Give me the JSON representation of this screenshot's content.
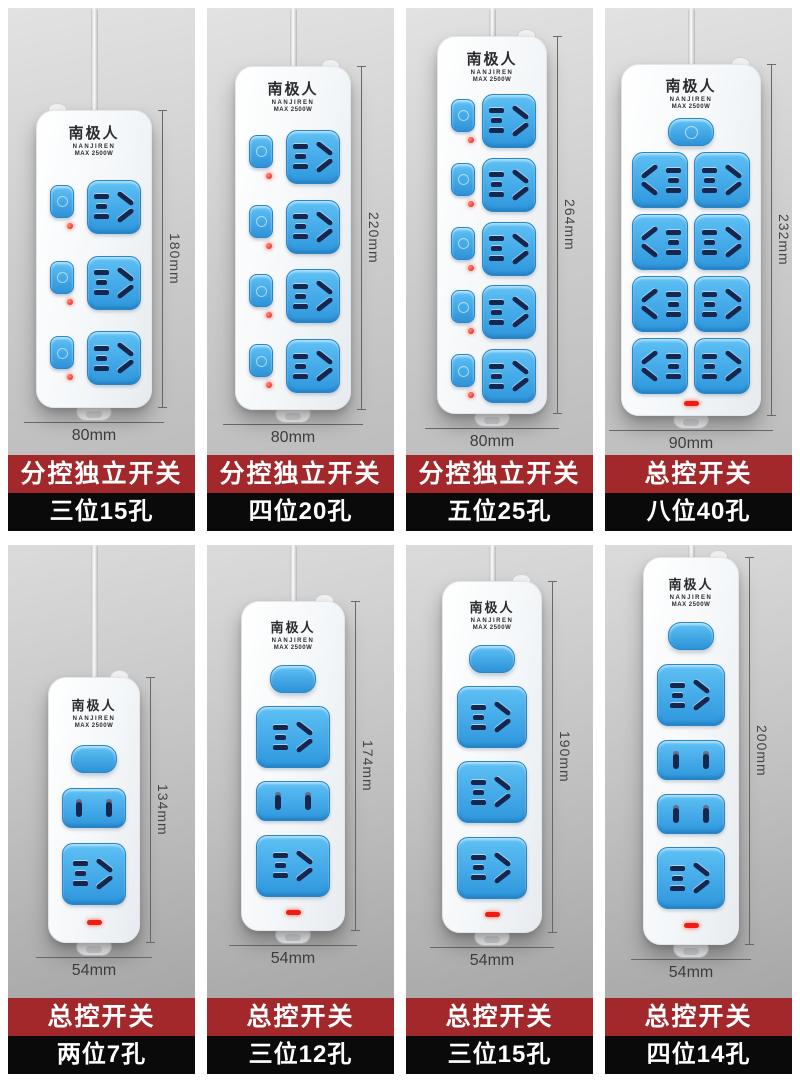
{
  "brand": {
    "name": "南极人",
    "latin": "NANJIREN",
    "power": "MAX 2500W"
  },
  "colors": {
    "banner_red": "#a2282b",
    "banner_black": "#0a0a0a",
    "socket_blue": "#3aa4e4",
    "strip_body": "#f5f7f9",
    "indicator_red": "#ef1c12",
    "background_gray": "#cccccc"
  },
  "products": [
    {
      "id": "p1",
      "switch_type": "individual",
      "banner": "分控独立开关",
      "spec": "三位15孔",
      "height": "180mm",
      "width": "80mm",
      "sockets": [
        "five",
        "five",
        "five"
      ]
    },
    {
      "id": "p2",
      "switch_type": "individual",
      "banner": "分控独立开关",
      "spec": "四位20孔",
      "height": "220mm",
      "width": "80mm",
      "sockets": [
        "five",
        "five",
        "five",
        "five"
      ]
    },
    {
      "id": "p3",
      "switch_type": "individual",
      "banner": "分控独立开关",
      "spec": "五位25孔",
      "height": "264mm",
      "width": "80mm",
      "sockets": [
        "five",
        "five",
        "five",
        "five",
        "five"
      ]
    },
    {
      "id": "p4",
      "switch_type": "master8",
      "banner": "总控开关",
      "spec": "八位40孔",
      "height": "232mm",
      "width": "90mm",
      "sockets": [
        "five",
        "five",
        "five",
        "five",
        "five",
        "five",
        "five",
        "five"
      ]
    },
    {
      "id": "p5",
      "switch_type": "master",
      "banner": "总控开关",
      "spec": "两位7孔",
      "height": "134mm",
      "width": "54mm",
      "sockets": [
        "two",
        "five"
      ]
    },
    {
      "id": "p6",
      "switch_type": "master",
      "banner": "总控开关",
      "spec": "三位12孔",
      "height": "174mm",
      "width": "54mm",
      "sockets": [
        "five",
        "two",
        "five"
      ]
    },
    {
      "id": "p7",
      "switch_type": "master",
      "banner": "总控开关",
      "spec": "三位15孔",
      "height": "190mm",
      "width": "54mm",
      "sockets": [
        "five",
        "five",
        "five"
      ]
    },
    {
      "id": "p8",
      "switch_type": "master",
      "banner": "总控开关",
      "spec": "四位14孔",
      "height": "200mm",
      "width": "54mm",
      "sockets": [
        "five",
        "two",
        "two",
        "five"
      ]
    }
  ]
}
